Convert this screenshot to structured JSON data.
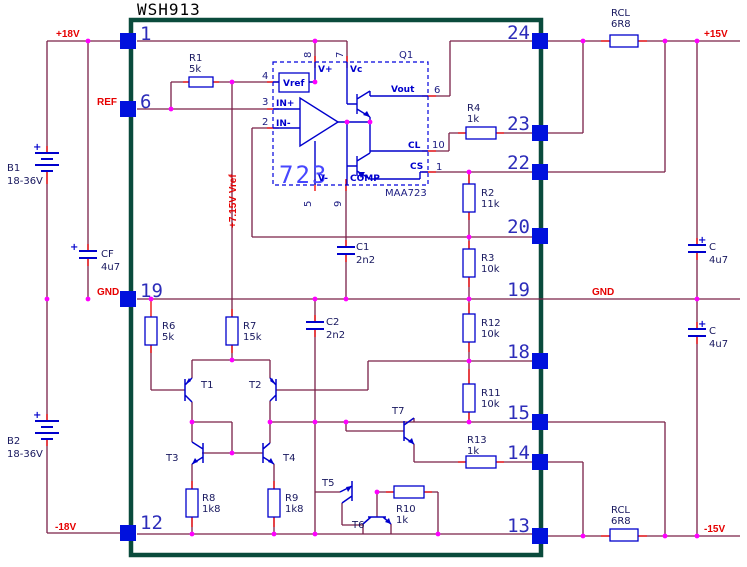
{
  "title": "WSH913",
  "plus": "+",
  "nets": {
    "p18": "+18V",
    "ref": "REF",
    "gndl": "GND",
    "n18": "-18V",
    "p15": "+15V",
    "gndr": "GND",
    "n15": "-15V",
    "vref": "+7.15V Vref"
  },
  "pins_left": [
    "1",
    "6",
    "19",
    "12"
  ],
  "pins_right": [
    "24",
    "23",
    "22",
    "20",
    "19",
    "18",
    "15",
    "14",
    "13"
  ],
  "ic": {
    "label": "723",
    "part": "MAA723",
    "desig": "Q1",
    "vp": {
      "n": "V+",
      "num": "8"
    },
    "vc": {
      "n": "Vc",
      "num": "7"
    },
    "vr": {
      "n": "Vref",
      "num": "4"
    },
    "inp": {
      "n": "IN+",
      "num": "3"
    },
    "inn": {
      "n": "IN-",
      "num": "2"
    },
    "vm": {
      "n": "V-",
      "num": "5"
    },
    "comp": {
      "n": "COMP",
      "num": "9"
    },
    "vo": {
      "n": "Vout",
      "num": "6"
    },
    "cl": {
      "n": "CL",
      "num": "10"
    },
    "cs": {
      "n": "CS",
      "num": "1"
    }
  },
  "components": {
    "r1": {
      "n": "R1",
      "v": "5k"
    },
    "r2": {
      "n": "R2",
      "v": "11k"
    },
    "r3": {
      "n": "R3",
      "v": "10k"
    },
    "r4": {
      "n": "R4",
      "v": "1k"
    },
    "r6": {
      "n": "R6",
      "v": "5k"
    },
    "r7": {
      "n": "R7",
      "v": "15k"
    },
    "r8": {
      "n": "R8",
      "v": "1k8"
    },
    "r9": {
      "n": "R9",
      "v": "1k8"
    },
    "r10": {
      "n": "R10",
      "v": "1k"
    },
    "r11": {
      "n": "R11",
      "v": "10k"
    },
    "r12": {
      "n": "R12",
      "v": "10k"
    },
    "r13": {
      "n": "R13",
      "v": "1k"
    },
    "rcl1": {
      "n": "RCL",
      "v": "6R8"
    },
    "rcl2": {
      "n": "RCL",
      "v": "6R8"
    },
    "c1": {
      "n": "C1",
      "v": "2n2"
    },
    "c2": {
      "n": "C2",
      "v": "2n2"
    },
    "cf": {
      "n": "CF",
      "v": "4u7"
    },
    "cp": {
      "n": "C",
      "v": "4u7"
    },
    "cn": {
      "n": "C",
      "v": "4u7"
    },
    "b1": {
      "n": "B1",
      "v": "18-36V"
    },
    "b2": {
      "n": "B2",
      "v": "18-36V"
    },
    "t1": {
      "n": "T1"
    },
    "t2": {
      "n": "T2"
    },
    "t3": {
      "n": "T3"
    },
    "t4": {
      "n": "T4"
    },
    "t5": {
      "n": "T5"
    },
    "t6": {
      "n": "T6"
    },
    "t7": {
      "n": "T7"
    }
  }
}
